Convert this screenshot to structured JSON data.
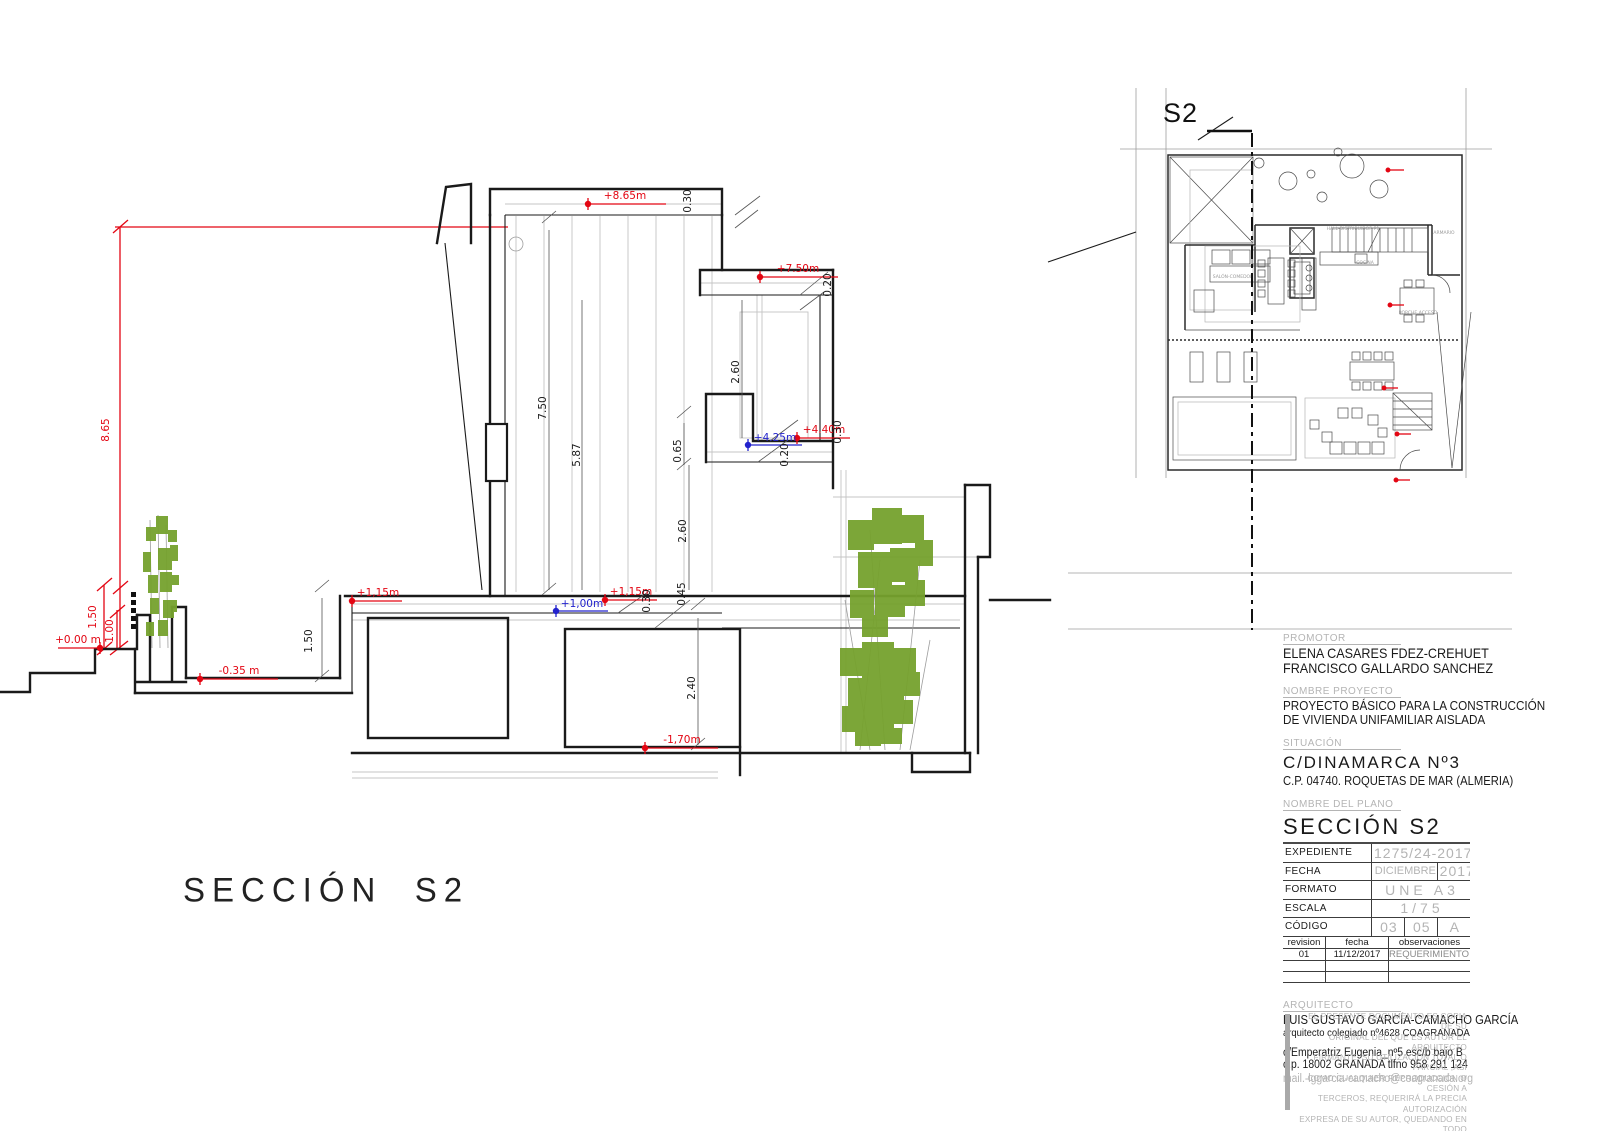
{
  "drawing": {
    "section_title": "SECCIÓN  S2",
    "plan_cut_label": "S2",
    "levels": [
      {
        "label": "+8.65m",
        "color": "red"
      },
      {
        "label": "+7.50m",
        "color": "red"
      },
      {
        "label": "+4.40m",
        "color": "red"
      },
      {
        "label": "+4.25m",
        "color": "blue"
      },
      {
        "label": "+1,15m",
        "color": "red"
      },
      {
        "label": "+1,00m",
        "color": "blue"
      },
      {
        "label": "+1,15m",
        "color": "red"
      },
      {
        "label": "+0.00 m",
        "color": "red"
      },
      {
        "label": "-0.35 m",
        "color": "red"
      },
      {
        "label": "-1,70m",
        "color": "red"
      }
    ],
    "dims": [
      "0.30",
      "0.20",
      "7.50",
      "5.87",
      "2.60",
      "0.65",
      "0.20",
      "0.30",
      "2.60",
      "0.30",
      "0.45",
      "2.40",
      "1.50",
      "8.65",
      "1.50",
      "1.00"
    ],
    "plan_room_labels": [
      "HALL-DISTRIBUIDOR P1",
      "ARMARIO",
      "COCINA",
      "SALÓN-COMEDOR",
      "PORCHE ACCESO"
    ]
  },
  "title_block": {
    "promotor_label": "PROMOTOR",
    "promotor_line1": "ELENA CASARES FDEZ-CREHUET",
    "promotor_line2": "FRANCISCO GALLARDO SANCHEZ",
    "project_label": "NOMBRE PROYECTO",
    "project_line1": "PROYECTO BÁSICO PARA LA CONSTRUCCIÓN",
    "project_line2": "DE VIVIENDA UNIFAMILIAR AISLADA",
    "situacion_label": "SITUACIÓN",
    "situacion_line1": "C/DINAMARCA Nº3",
    "situacion_line2": "C.P. 04740. ROQUETAS DE MAR (ALMERIA)",
    "plano_label": "NOMBRE DEL PLANO",
    "plano_name": "SECCIÓN S2",
    "expediente_label": "EXPEDIENTE",
    "expediente_value": "1275/24-2017",
    "fecha_label": "FECHA",
    "fecha_value1": "DICIEMBRE",
    "fecha_value2": "2017",
    "formato_label": "FORMATO",
    "formato_value": "UNE A3",
    "escala_label": "ESCALA",
    "escala_value": "1/75",
    "codigo_label": "CÓDIGO",
    "codigo_value1": "03",
    "codigo_value2": "05",
    "codigo_value3": "A",
    "rev_h1": "revision",
    "rev_h2": "fecha",
    "rev_h3": "observaciones",
    "rev_v1": "01",
    "rev_v2": "11/12/2017",
    "rev_v3": "REQUERIMIENTO MUNICIPAL 14/11/2017",
    "arquitecto_label": "ARQUITECTO",
    "arquitecto_name": "LUIS GUSTAVO GARCÍA-CAMACHO GARCÍA",
    "arquitecto_sub": "arquitecto colegiado nº4628 COAGRANADA",
    "address_line1": "c/Emperatriz Eugenia_nº5 esc/b bajo B",
    "address_line2": "c.p. 18002 GRANADA   tlfno 958 291 124",
    "mail": "mail.-lggarcia-camacho@coagranada.org",
    "disclaimer": [
      "EL PRESENTE DOCUMENTO ES COPIA DE SU",
      "ORIGINAL DEL QUE ES AUTOR EL ARQUITECTO",
      "FIRMANTE. SU UTILIZACIÓN TOTAL O PARCIAL ,ASÍ",
      "COMO CUALQUIER REPRODUCCIÓN O CESIÓN A",
      "TERCEROS, REQUERIRÁ LA PRECIA AUTORIZACIÓN",
      "EXPRESA DE SU AUTOR, QUEDANDO EN TODO",
      "CASO PROHIBIDA CUALQUIER MODIFICACIÓN",
      "UNILATERAL DEL MISMO"
    ]
  },
  "colors": {
    "red": "#e30613",
    "blue": "#2323cd",
    "green": "#76a22e",
    "gray": "#b4b4b4"
  }
}
